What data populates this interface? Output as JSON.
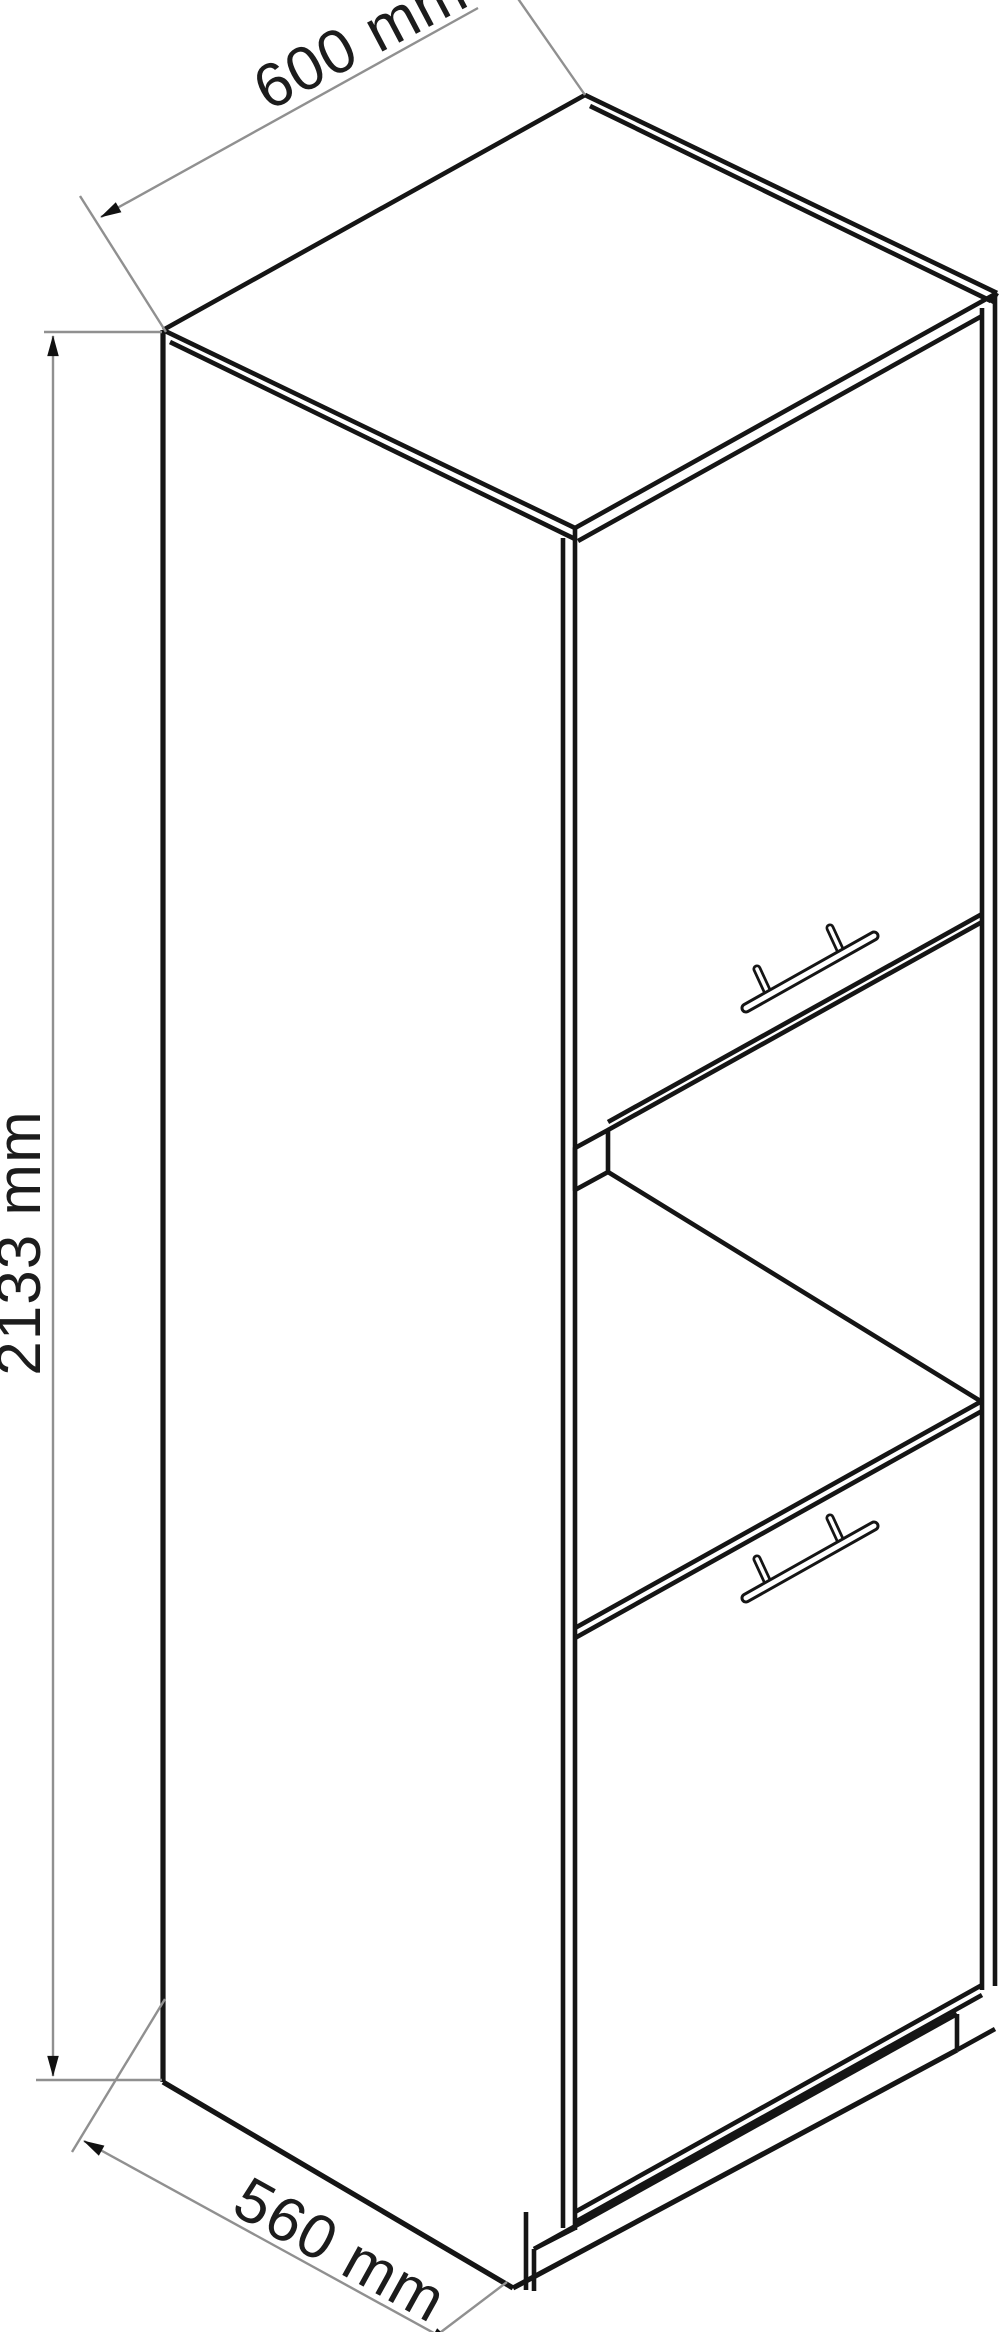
{
  "drawing": {
    "title": "tall-oven-housing-cabinet-technical-line-drawing",
    "projection": "isometric",
    "background": "#ffffff",
    "outline_color": "#151515",
    "dimension_line_color": "#909090",
    "label_color": "#1c1c1c"
  },
  "dimensions": {
    "width": "600 mm",
    "height": "2133 mm",
    "depth": "560 mm"
  }
}
